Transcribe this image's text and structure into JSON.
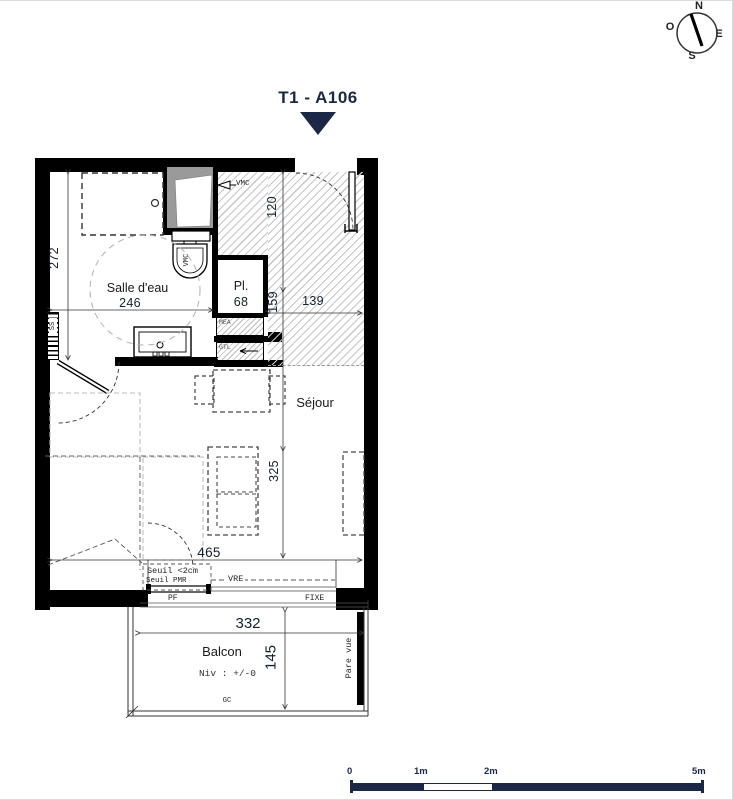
{
  "title": {
    "label": "T1 - A106"
  },
  "compass": {
    "n": "N",
    "o": "O",
    "e": "E",
    "s": "S"
  },
  "rooms": {
    "salle_deau": {
      "name": "Salle d'eau",
      "dim": "246"
    },
    "placard": {
      "name": "Pl.",
      "dim": "68"
    },
    "sejour": {
      "name": "Séjour"
    },
    "balcon": {
      "name": "Balcon",
      "level": "Niv : +/-0"
    }
  },
  "dimensions": {
    "d272": "272",
    "d120": "120",
    "d159": "159",
    "d139": "139",
    "d325": "325",
    "d465": "465",
    "d332": "332",
    "d145": "145"
  },
  "annotations": {
    "vmc_duct": "VMC",
    "vmc_wc": "VMC",
    "ss": "SS",
    "mea": "MEA",
    "gtl": "GTL",
    "seuil": "Seuil <2cm",
    "seuil_pmr": "Seuil PMR",
    "vre": "VRE",
    "pf": "PF",
    "fixe": "FIXE",
    "gc": "GC",
    "pare_vue": "Pare vue"
  },
  "scale_bar": {
    "t0": "0",
    "t1": "1m",
    "t2": "2m",
    "t5": "5m"
  },
  "colors": {
    "navy": "#1b2845",
    "wall": "#000000"
  }
}
